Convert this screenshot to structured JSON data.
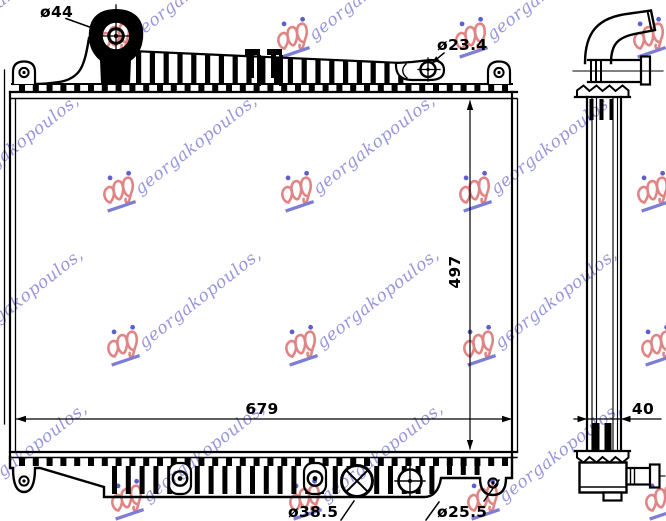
{
  "title": "Radiator technical drawing",
  "watermark": {
    "text": "georgakopoulos,",
    "text_color": "#7d7dd6",
    "crown_color": "#e08484",
    "dot_color": "#5e5ecc"
  },
  "drawing": {
    "line_color": "#000000",
    "dimensions": {
      "filler_neck_diameter": "ø44",
      "inlet_diameter": "ø23.4",
      "core_height": "497",
      "core_width": "679",
      "core_depth": "40",
      "drain_plug_diameter": "ø38.5",
      "outlet_diameter": "ø25.5"
    }
  }
}
